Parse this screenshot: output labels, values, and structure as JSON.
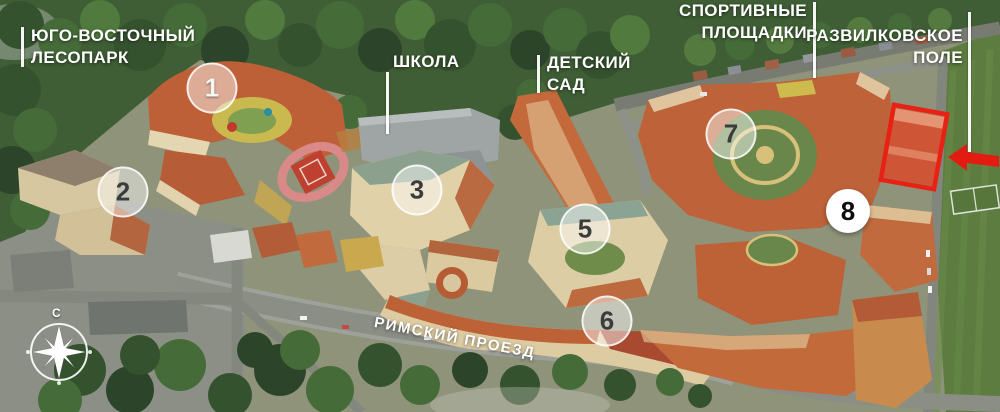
{
  "map": {
    "area_labels": {
      "forest": {
        "line1": "ЮГО-ВОСТОЧНЫЙ",
        "line2": "ЛЕСОПАРК"
      },
      "school": {
        "text": "ШКОЛА"
      },
      "kindergarten": {
        "line1": "ДЕТСКИЙ",
        "line2": "САД"
      },
      "sports": {
        "line1": "СПОРТИВНЫЕ",
        "line2": "ПЛОЩАДКИ"
      },
      "field": {
        "line1": "РАЗВИЛКОВСКОЕ",
        "line2": "ПОЛЕ"
      },
      "street": {
        "text": "РИМСКИЙ ПРОЕЗД"
      }
    },
    "building_markers": [
      {
        "num": "1"
      },
      {
        "num": "2"
      },
      {
        "num": "3"
      },
      {
        "num": "5"
      },
      {
        "num": "6"
      },
      {
        "num": "7"
      },
      {
        "num": "8"
      }
    ],
    "compass": {
      "north": "С"
    },
    "palette": {
      "highlight_red": "#e82114",
      "label_white": "#ffffff",
      "roof_terracotta": "#bd6239",
      "forest_green": "#3f5e35",
      "field_green": "#5d7c40"
    }
  }
}
